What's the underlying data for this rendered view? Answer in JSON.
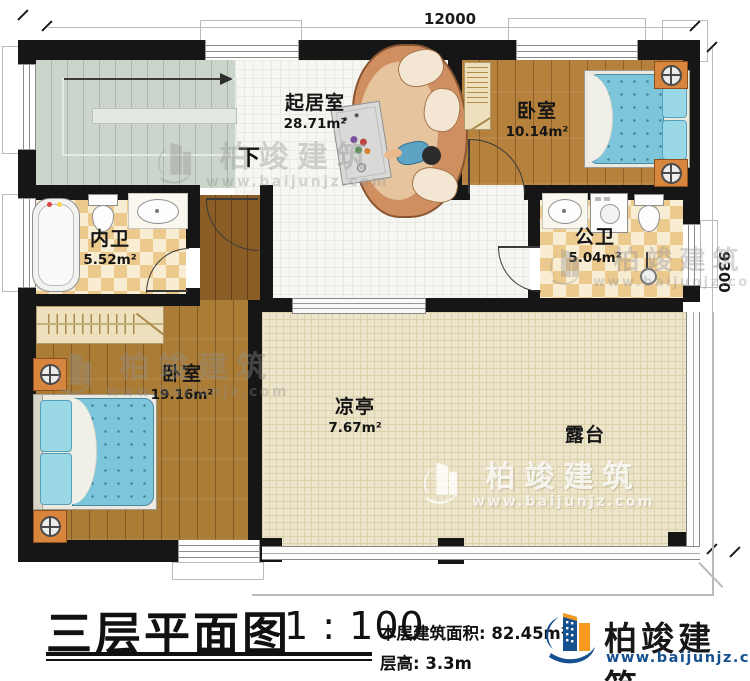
{
  "dimensions": {
    "top": "12000",
    "right": "9300"
  },
  "stairs": {
    "down_label": "下"
  },
  "rooms": {
    "living": {
      "name": "起居室",
      "area": "28.71m²"
    },
    "bedroom_top": {
      "name": "卧室",
      "area": "10.14m²"
    },
    "bath_inner": {
      "name": "内卫",
      "area": "5.52m²"
    },
    "bath_public": {
      "name": "公卫",
      "area": "5.04m²"
    },
    "bedroom_left": {
      "name": "卧室",
      "area": "19.16m²"
    },
    "pavilion": {
      "name": "凉亭",
      "area": "7.67m²"
    },
    "terrace": {
      "name": "露台"
    }
  },
  "title_block": {
    "title": "三层平面图",
    "scale": "1 : 100",
    "area_label": "本层建筑面积:",
    "area_value": "82.45m²",
    "height_label": "层高:",
    "height_value": "3.3m"
  },
  "brand": {
    "name": "柏竣建筑",
    "website": "www.baijunjz.com"
  },
  "watermark": {
    "text": "柏竣建筑",
    "website": "www.baijunjz.com"
  },
  "colors": {
    "wall": "#161616",
    "wood": "#b5813c",
    "brand_blue": "#15508f",
    "brand_orange": "#f59a1e",
    "bed_blue": "#7cc5da"
  }
}
